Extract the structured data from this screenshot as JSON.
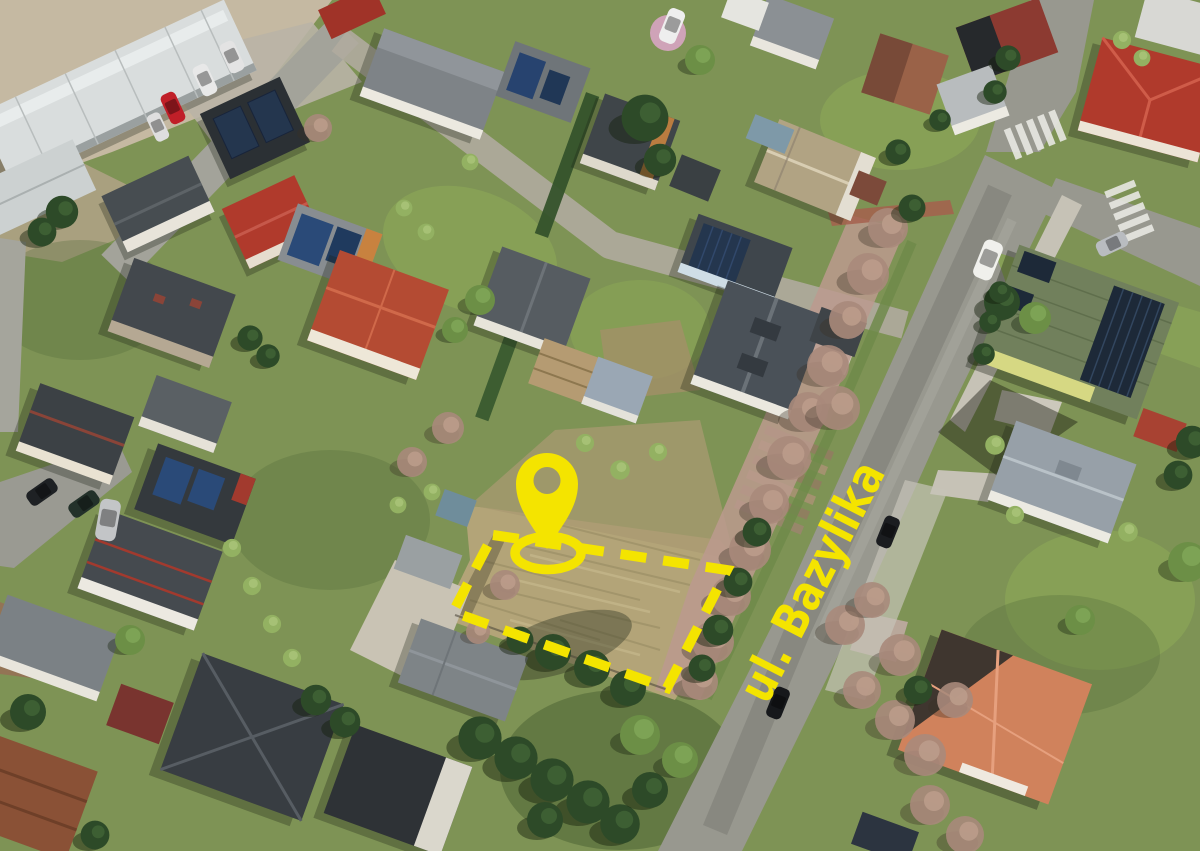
{
  "annotations": {
    "street_label": "ul. Bazylika",
    "accent_color": "#F4E400",
    "marker": "location-pin",
    "plot_outline": "dashed quadrilateral highlighting vacant parcel"
  },
  "scene": {
    "description": "Aerial drone photo of a suburban neighborhood with a vacant grass plot marked for sale beside ul. Bazylika street",
    "palette": {
      "lawn": "#7e9355",
      "lawn_bright": "#8fae57",
      "dry_grass": "#b3a478",
      "asphalt": "#98988f",
      "paving_pink": "#bb9a8e",
      "conifer": "#2d4a28",
      "bare_tree": "#a8897b",
      "concrete": "#c6c2b6",
      "roof_dark": "#34393d",
      "roof_red": "#b03a2c",
      "roof_tile_orange": "#d0825c",
      "roof_green": "#71805c",
      "solar_panel": "#24364e",
      "warehouse_roof": "#d9dddd"
    }
  }
}
